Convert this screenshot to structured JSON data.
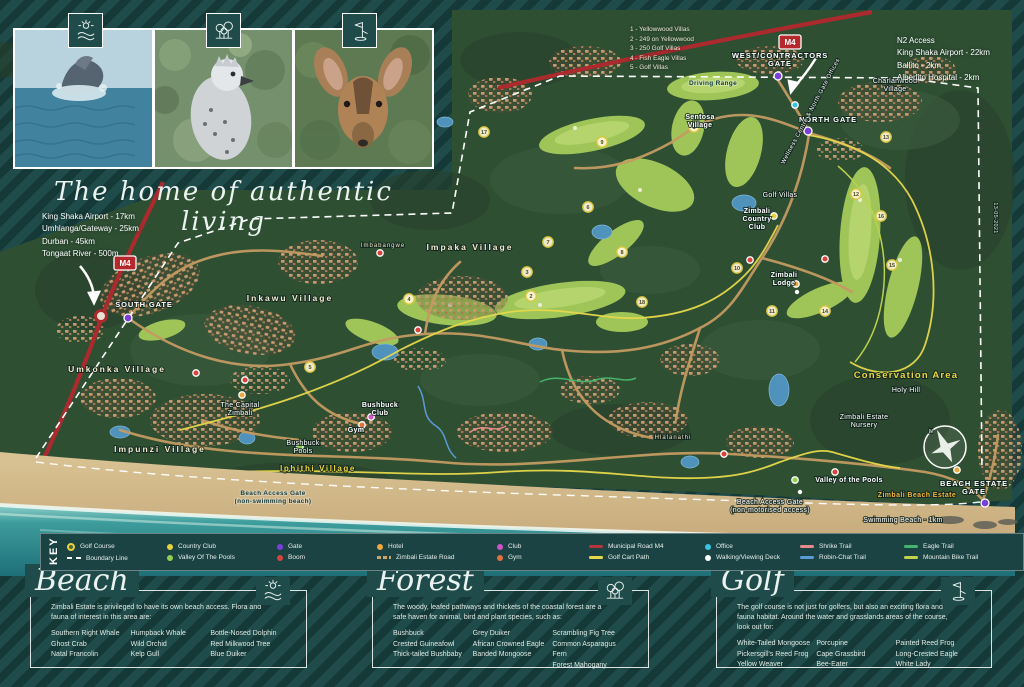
{
  "tagline": "The home of authentic living",
  "gallery": {
    "photos": [
      {
        "name": "whale-photo",
        "icon": "beach"
      },
      {
        "name": "eagle-photo",
        "icon": "forest"
      },
      {
        "name": "duiker-photo",
        "icon": "golf"
      }
    ]
  },
  "map": {
    "m4": "M4",
    "badges": [
      {
        "x": 125,
        "y": 263
      },
      {
        "x": 790,
        "y": 42
      }
    ],
    "info_left": [
      "King Shaka Airport - 17km",
      "Umhlanga/Gateway - 25km",
      "Durban - 45km",
      "Tongaat River - 500m"
    ],
    "info_right": {
      "title": "N2 Access",
      "lines": [
        "King Shaka Airport - 22km",
        "Ballito - 2km",
        "Alberlito Hospital - 2km"
      ]
    },
    "villa_index": [
      "1 - Yellowwood Villas",
      "2 - 249 on Yellowwood",
      "3 - 250 Golf Villas",
      "4 - Fish Eagle Villas",
      "5 - Golf Villas"
    ],
    "labels": [
      {
        "text": "SOUTH GATE",
        "x": 144,
        "y": 307,
        "cls": "gate"
      },
      {
        "text": "NORTH GATE",
        "x": 828,
        "y": 122,
        "cls": "gate"
      },
      {
        "text": "WEST/CONTRACTORS",
        "x": 780,
        "y": 58,
        "cls": "gate"
      },
      {
        "text": "GATE",
        "x": 780,
        "y": 66,
        "cls": "gate"
      },
      {
        "text": "BEACH ESTATE",
        "x": 974,
        "y": 486,
        "cls": "gate"
      },
      {
        "text": "GATE",
        "x": 974,
        "y": 494,
        "cls": "gate"
      },
      {
        "text": "Driving Range",
        "x": 713,
        "y": 85,
        "cls": "dark"
      },
      {
        "text": "Sentosa",
        "x": 700,
        "y": 119,
        "cls": "place-bold"
      },
      {
        "text": "Village",
        "x": 700,
        "y": 127,
        "cls": "place-bold"
      },
      {
        "text": "Charlanwood",
        "x": 895,
        "y": 83,
        "cls": "place"
      },
      {
        "text": "Village",
        "x": 895,
        "y": 91,
        "cls": "place"
      },
      {
        "text": "Umkonka Village",
        "x": 117,
        "y": 372,
        "cls": "village"
      },
      {
        "text": "Inkawu Village",
        "x": 290,
        "y": 301,
        "cls": "village"
      },
      {
        "text": "Impaka Village",
        "x": 470,
        "y": 250,
        "cls": "village"
      },
      {
        "text": "Imbabangwe",
        "x": 383,
        "y": 247,
        "cls": "village-sm"
      },
      {
        "text": "Impunzi Village",
        "x": 160,
        "y": 452,
        "cls": "village"
      },
      {
        "text": "Iphithi Village",
        "x": 318,
        "y": 471,
        "cls": "village-yellow"
      },
      {
        "text": "Hlalanathi",
        "x": 673,
        "y": 439,
        "cls": "village-sm"
      },
      {
        "text": "Zimbali",
        "x": 757,
        "y": 213,
        "cls": "place-bold"
      },
      {
        "text": "Country",
        "x": 757,
        "y": 221,
        "cls": "place-bold"
      },
      {
        "text": "Club",
        "x": 757,
        "y": 229,
        "cls": "place-bold"
      },
      {
        "text": "Zimbali",
        "x": 784,
        "y": 277,
        "cls": "place-bold"
      },
      {
        "text": "Lodge",
        "x": 784,
        "y": 285,
        "cls": "place-bold"
      },
      {
        "text": "Golf Villas",
        "x": 780,
        "y": 197,
        "cls": "place"
      },
      {
        "text": "Bushbuck",
        "x": 380,
        "y": 407,
        "cls": "place-bold"
      },
      {
        "text": "Club",
        "x": 380,
        "y": 415,
        "cls": "place-bold"
      },
      {
        "text": "Gym",
        "x": 356,
        "y": 432,
        "cls": "place-bold"
      },
      {
        "text": "Bushbuck",
        "x": 303,
        "y": 445,
        "cls": "place"
      },
      {
        "text": "Pools",
        "x": 303,
        "y": 453,
        "cls": "place"
      },
      {
        "text": "The Capital",
        "x": 240,
        "y": 407,
        "cls": "place"
      },
      {
        "text": "Zimbali",
        "x": 240,
        "y": 415,
        "cls": "place"
      },
      {
        "text": "Valley of the Pools",
        "x": 849,
        "y": 482,
        "cls": "place-bold"
      },
      {
        "text": "Conservation Area",
        "x": 906,
        "y": 378,
        "cls": "conservation"
      },
      {
        "text": "Holy Hill",
        "x": 906,
        "y": 392,
        "cls": "place"
      },
      {
        "text": "Zimbali Estate",
        "x": 864,
        "y": 419,
        "cls": "place"
      },
      {
        "text": "Nursery",
        "x": 864,
        "y": 427,
        "cls": "place"
      },
      {
        "text": "Zimbali Beach Estate",
        "x": 917,
        "y": 497,
        "cls": "orange"
      },
      {
        "text": "Swimming Beach - 1km",
        "x": 903,
        "y": 522,
        "cls": "place"
      },
      {
        "text": "Beach Access Gate",
        "x": 273,
        "y": 495,
        "cls": "dark"
      },
      {
        "text": "(non-swimming beach)",
        "x": 273,
        "y": 503,
        "cls": "dark"
      },
      {
        "text": "Beach Access Gate",
        "x": 770,
        "y": 504,
        "cls": "place"
      },
      {
        "text": "(non-motorised access)",
        "x": 770,
        "y": 512,
        "cls": "place"
      },
      {
        "text": "Wellness Centre & North Gate Offices",
        "x": 812,
        "y": 112,
        "cls": "rot",
        "rot": -62
      },
      {
        "text": "13-05-2021",
        "x": 994,
        "y": 218,
        "cls": "rot-sm",
        "rot": 90
      },
      {
        "text": "N",
        "x": 931,
        "y": 433,
        "cls": "rot-sm"
      }
    ],
    "markers": [
      {
        "type": "gate",
        "x": 128,
        "y": 318
      },
      {
        "type": "gate",
        "x": 778,
        "y": 76
      },
      {
        "type": "gate",
        "x": 808,
        "y": 131
      },
      {
        "type": "gate",
        "x": 985,
        "y": 503
      },
      {
        "type": "boom",
        "x": 196,
        "y": 373
      },
      {
        "type": "boom",
        "x": 245,
        "y": 380
      },
      {
        "type": "boom",
        "x": 380,
        "y": 253
      },
      {
        "type": "boom",
        "x": 750,
        "y": 260
      },
      {
        "type": "boom",
        "x": 825,
        "y": 259
      },
      {
        "type": "boom",
        "x": 724,
        "y": 454
      },
      {
        "type": "boom",
        "x": 835,
        "y": 472
      },
      {
        "type": "boom",
        "x": 418,
        "y": 330
      },
      {
        "type": "hotel",
        "x": 242,
        "y": 395
      },
      {
        "type": "hotel",
        "x": 796,
        "y": 284
      },
      {
        "type": "hotel",
        "x": 957,
        "y": 470
      },
      {
        "type": "club",
        "x": 371,
        "y": 417
      },
      {
        "type": "gym",
        "x": 362,
        "y": 425
      },
      {
        "type": "office",
        "x": 795,
        "y": 105
      },
      {
        "type": "country-club",
        "x": 774,
        "y": 216
      },
      {
        "type": "valley",
        "x": 795,
        "y": 480
      },
      {
        "type": "valley",
        "x": 300,
        "y": 447
      },
      {
        "type": "deck",
        "x": 797,
        "y": 292
      },
      {
        "type": "deck",
        "x": 800,
        "y": 492
      }
    ],
    "holes": [
      [
        1,
        694,
        127
      ],
      [
        2,
        531,
        296
      ],
      [
        3,
        527,
        272
      ],
      [
        4,
        409,
        299
      ],
      [
        5,
        310,
        367
      ],
      [
        6,
        588,
        207
      ],
      [
        7,
        548,
        242
      ],
      [
        8,
        622,
        252
      ],
      [
        9,
        602,
        142
      ],
      [
        10,
        737,
        268
      ],
      [
        11,
        772,
        311
      ],
      [
        12,
        856,
        194
      ],
      [
        13,
        886,
        137
      ],
      [
        14,
        825,
        311
      ],
      [
        15,
        892,
        265
      ],
      [
        16,
        881,
        216
      ],
      [
        17,
        484,
        132
      ],
      [
        18,
        642,
        302
      ]
    ]
  },
  "key": {
    "title": "KEY",
    "columns": [
      {
        "w": 100,
        "items": [
          {
            "label": "Golf Course",
            "swatch": "golf"
          },
          {
            "label": "Boundary Line",
            "swatch": "boundary"
          }
        ]
      },
      {
        "w": 110,
        "items": [
          {
            "label": "Country Club",
            "swatch": "dot",
            "color": "#e8d23c"
          },
          {
            "label": "Valley Of The Pools",
            "swatch": "dot",
            "color": "#8fd14f"
          }
        ]
      },
      {
        "w": 100,
        "items": [
          {
            "label": "Gate",
            "swatch": "dot",
            "color": "#7a3fd6"
          },
          {
            "label": "Boom",
            "swatch": "dot",
            "color": "#d8443c"
          }
        ]
      },
      {
        "w": 120,
        "items": [
          {
            "label": "Hotel",
            "swatch": "dot",
            "color": "#eda83f"
          },
          {
            "label": "Zimbali Estate Road",
            "swatch": "dash"
          }
        ]
      },
      {
        "w": 92,
        "items": [
          {
            "label": "Club",
            "swatch": "dot",
            "color": "#cf54c6"
          },
          {
            "label": "Gym",
            "swatch": "dot",
            "color": "#e2703a"
          }
        ]
      },
      {
        "w": 116,
        "items": [
          {
            "label": "Municipal Road M4",
            "swatch": "line",
            "color": "#b5353a"
          },
          {
            "label": "Golf Cart Path",
            "swatch": "line",
            "color": "#e6d84a"
          }
        ]
      },
      {
        "w": 95,
        "items": [
          {
            "label": "Office",
            "swatch": "dot",
            "color": "#36c4e4"
          },
          {
            "label": "Walking/Viewing Deck",
            "swatch": "dot",
            "color": "#ffffff"
          }
        ]
      },
      {
        "w": 104,
        "items": [
          {
            "label": "Shrike Trail",
            "swatch": "line",
            "color": "#e58a8a"
          },
          {
            "label": "Robin-Chat Trail",
            "swatch": "line",
            "color": "#5b9bd5"
          }
        ]
      },
      {
        "w": 112,
        "items": [
          {
            "label": "Eagle Trail",
            "swatch": "line",
            "color": "#45b36b"
          },
          {
            "label": "Mountain Bike Trail",
            "swatch": "line",
            "color": "#c3d24b"
          }
        ]
      }
    ]
  },
  "sections": [
    {
      "title": "Beach",
      "icon": "beach",
      "left": 30,
      "width": 277,
      "intro": "Zimbali Estate is privileged to have its own beach access. Flora and fauna of interest in this area are:",
      "columns": [
        [
          "Southern Right Whale",
          "Ghost Crab",
          "Natal Francolin"
        ],
        [
          "Humpback Whale",
          "Wild Orchid",
          "Kelp Gull"
        ],
        [
          "Bottle-Nosed Dolphin",
          "Red Milkwood Tree",
          "Blue Duiker"
        ]
      ]
    },
    {
      "title": "Forest",
      "icon": "forest",
      "left": 372,
      "width": 277,
      "intro": "The woody, leafed pathways and thickets of the coastal forest are a safe haven for animal, bird and plant species, such as:",
      "columns": [
        [
          "Bushbuck",
          "Crested Guineafowl",
          "Thick-tailed Bushbaby"
        ],
        [
          "Grey Duiker",
          "African Crowned Eagle",
          "Banded Mongoose"
        ],
        [
          "Scrambling Fig Tree",
          "Common Asparagus Fern",
          "Forest Mahogany"
        ]
      ]
    },
    {
      "title": "Golf",
      "icon": "golf",
      "left": 716,
      "width": 276,
      "intro": "The golf course is not just for golfers, but also an exciting flora and fauna habitat. Around the water and grasslands areas of the course, look out for:",
      "columns": [
        [
          "White-Tailed Mongoose",
          "Pickersgill's Reed Frog",
          "Yellow Weaver"
        ],
        [
          "Porcupine",
          "Cape Grassbird",
          "Bee-Eater"
        ],
        [
          "Painted Reed Frog",
          "Long-Crested Eagle",
          "White Lady"
        ]
      ]
    }
  ]
}
